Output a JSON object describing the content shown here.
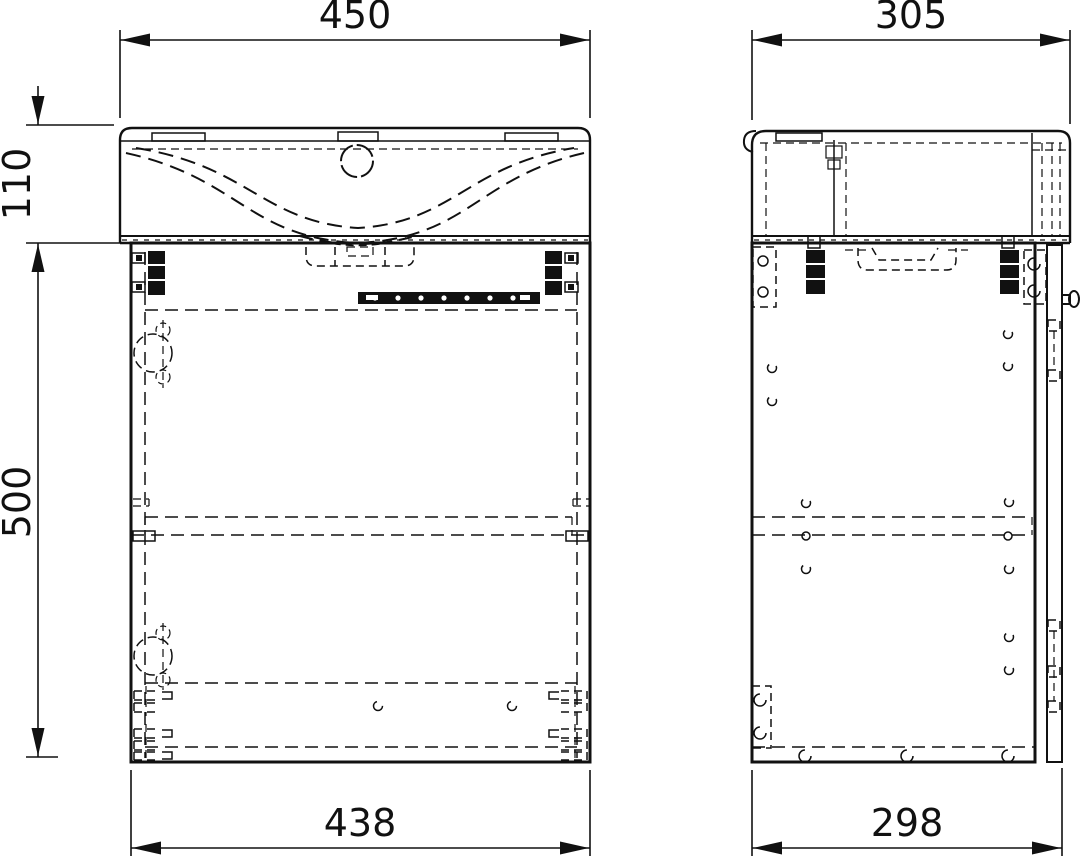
{
  "drawing_title": "vanity-unit-with-basin-technical-drawing",
  "colors": {
    "line": "#111111",
    "background": "#ffffff"
  },
  "dimensions": {
    "basin_width": "450",
    "basin_depth": "305",
    "basin_height": "110",
    "cabinet_height": "500",
    "cabinet_width": "438",
    "cabinet_depth": "298"
  }
}
